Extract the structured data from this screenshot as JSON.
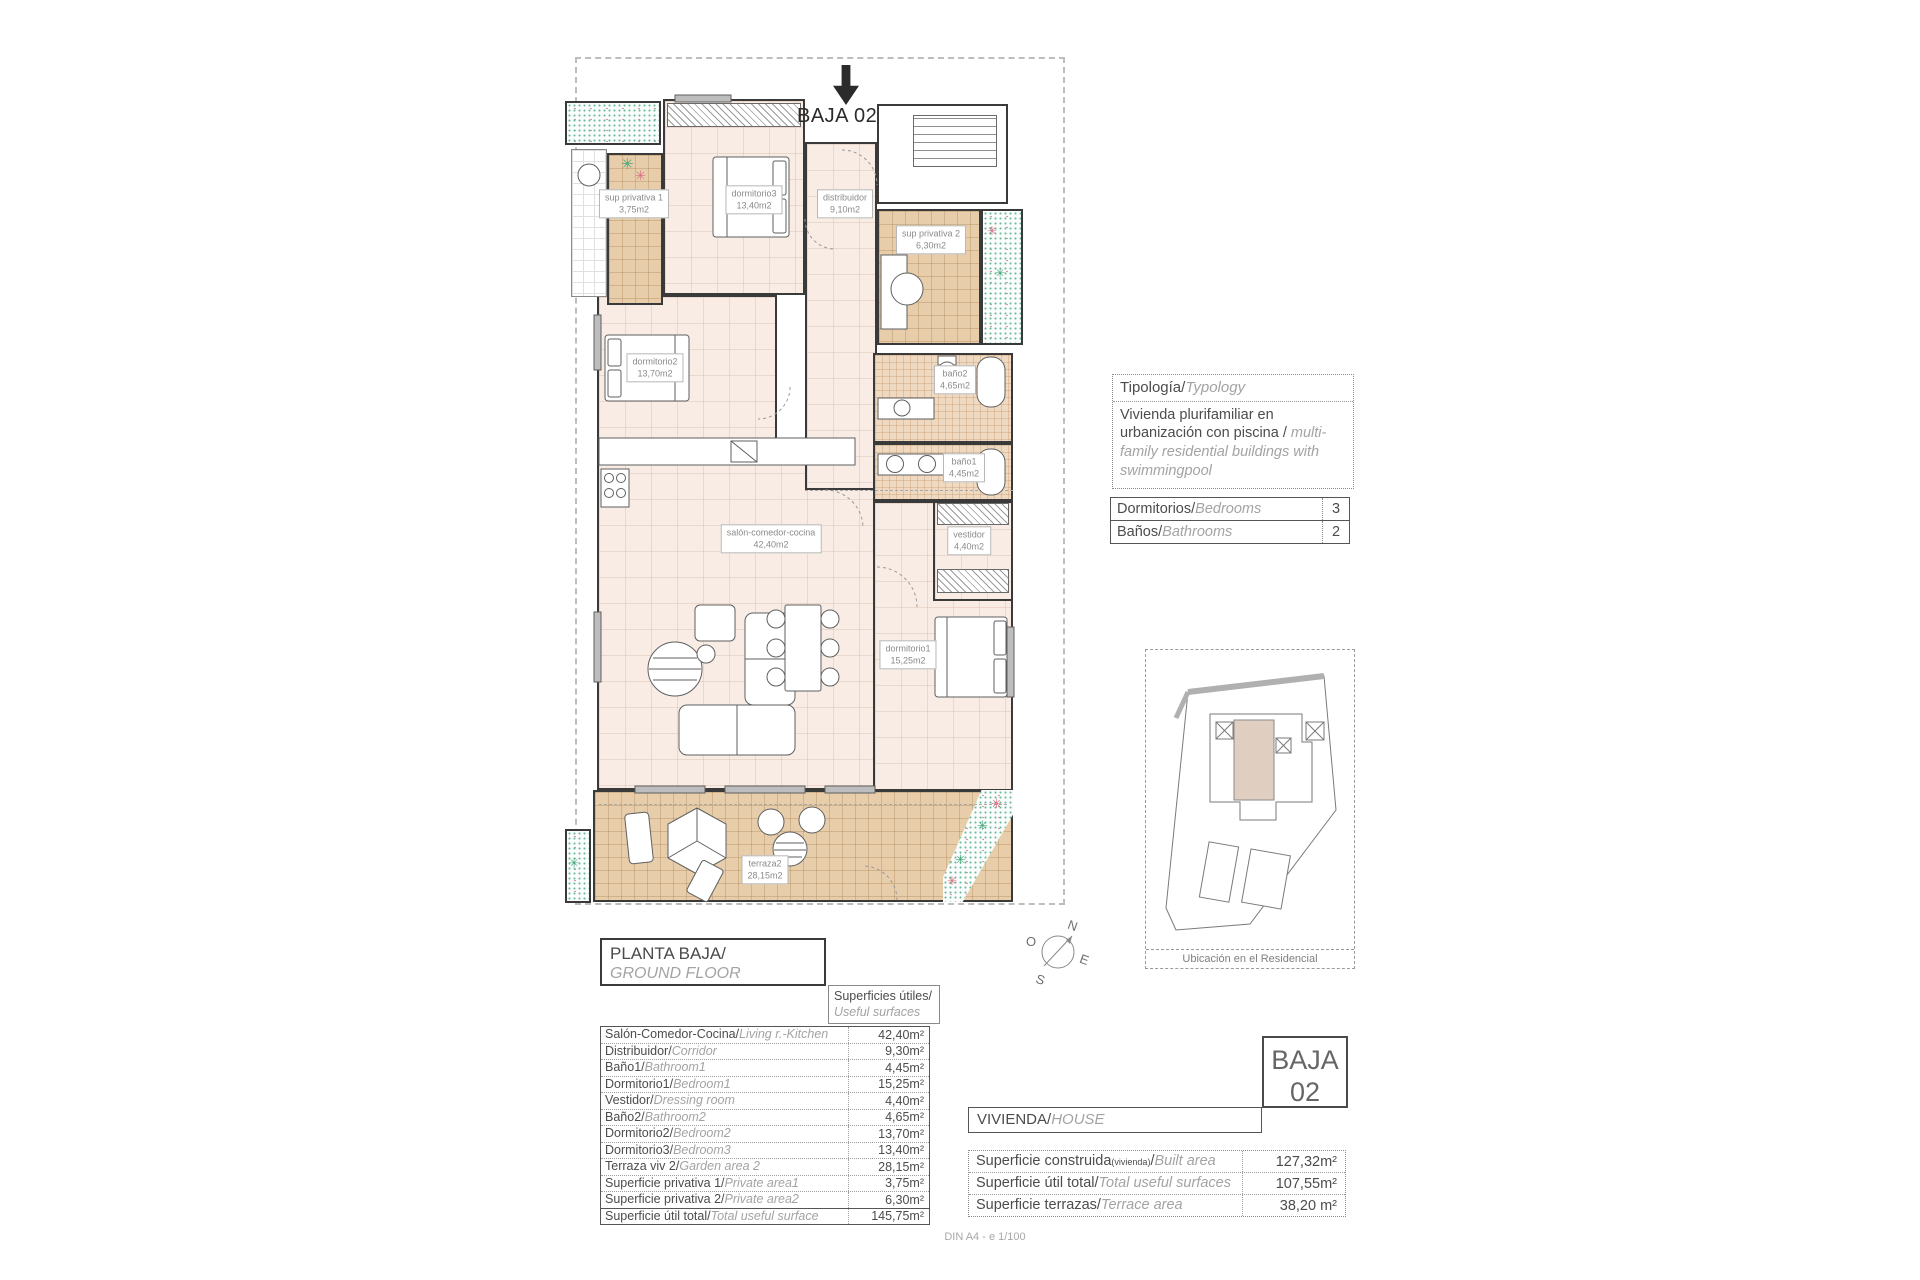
{
  "unit_label": "BAJA 02",
  "plan": {
    "rooms": [
      {
        "name": "sup privativa 1",
        "area": "3,75m2"
      },
      {
        "name": "dormitorio3",
        "area": "13,40m2"
      },
      {
        "name": "distribuidor",
        "area": "9,10m2"
      },
      {
        "name": "sup privativa 2",
        "area": "6,30m2"
      },
      {
        "name": "baño2",
        "area": "4,65m2"
      },
      {
        "name": "dormitorio2",
        "area": "13,70m2"
      },
      {
        "name": "baño1",
        "area": "4,45m2"
      },
      {
        "name": "salón-comedor-cocina",
        "area": "42,40m2"
      },
      {
        "name": "vestidor",
        "area": "4,40m2"
      },
      {
        "name": "dormitorio1",
        "area": "15,25m2"
      },
      {
        "name": "terraza2",
        "area": "28,15m2"
      }
    ]
  },
  "typology": {
    "label_es": "Tipología/",
    "label_en": "Typology",
    "text_es": "Vivienda plurifamiliar en urbanización con piscina  / ",
    "text_en": "multi-family residential buildings with swimmingpool"
  },
  "counts": {
    "bedrooms_es": "Dormitorios/",
    "bedrooms_en": "Bedrooms",
    "bedrooms_value": "3",
    "bathrooms_es": "Baños/",
    "bathrooms_en": "Bathrooms",
    "bathrooms_value": "2"
  },
  "site_plan": {
    "caption": "Ubicación en el Residencial"
  },
  "compass": {
    "n": "N",
    "s": "S",
    "e": "E",
    "o": "O"
  },
  "floor_title": {
    "es": "PLANTA BAJA/",
    "en": "GROUND FLOOR"
  },
  "useful_header": {
    "es": "Superficies útiles/",
    "en": "Useful surfaces"
  },
  "useful_table": {
    "rows": [
      {
        "es": "Salón-Comedor-Cocina/",
        "en": "Living r.-Kitchen",
        "value": "42,40m²"
      },
      {
        "es": "Distribuidor/",
        "en": "Corridor",
        "value": "9,30m²"
      },
      {
        "es": "Baño1/",
        "en": "Bathroom1",
        "value": "4,45m²"
      },
      {
        "es": "Dormitorio1/",
        "en": "Bedroom1",
        "value": "15,25m²"
      },
      {
        "es": "Vestidor/",
        "en": "Dressing room",
        "value": "4,40m²"
      },
      {
        "es": "Baño2/",
        "en": "Bathroom2",
        "value": "4,65m²"
      },
      {
        "es": "Dormitorio2/",
        "en": "Bedroom2",
        "value": "13,70m²"
      },
      {
        "es": "Dormitorio3/",
        "en": "Bedroom3",
        "value": "13,40m²"
      },
      {
        "es": "Terraza viv 2/",
        "en": "Garden area 2",
        "value": "28,15m²"
      },
      {
        "es": "Superficie privativa 1/",
        "en": "Private area1",
        "value": "3,75m²"
      },
      {
        "es": "Superficie privativa 2/",
        "en": "Private area2",
        "value": "6,30m²"
      },
      {
        "es": "Superficie útil total/",
        "en": "Total useful surface",
        "value": "145,75m²"
      }
    ]
  },
  "house_bar": {
    "es": "VIVIENDA/",
    "en": "HOUSE"
  },
  "unit_box": {
    "line1": "BAJA",
    "line2": "02"
  },
  "summary_table": {
    "rows": [
      {
        "es": "Superficie construida",
        "sub": "(vivienda)",
        "sep": "/",
        "en": "Built area",
        "value": "127,32m²"
      },
      {
        "es": "Superficie útil total",
        "sub": "",
        "sep": "/",
        "en": "Total useful surfaces",
        "value": "107,55m²"
      },
      {
        "es": "Superficie terrazas",
        "sub": "",
        "sep": "/",
        "en": "Terrace area",
        "value": "38,20 m²"
      }
    ]
  },
  "footer": {
    "scale": "DIN A4 - e 1/100"
  }
}
